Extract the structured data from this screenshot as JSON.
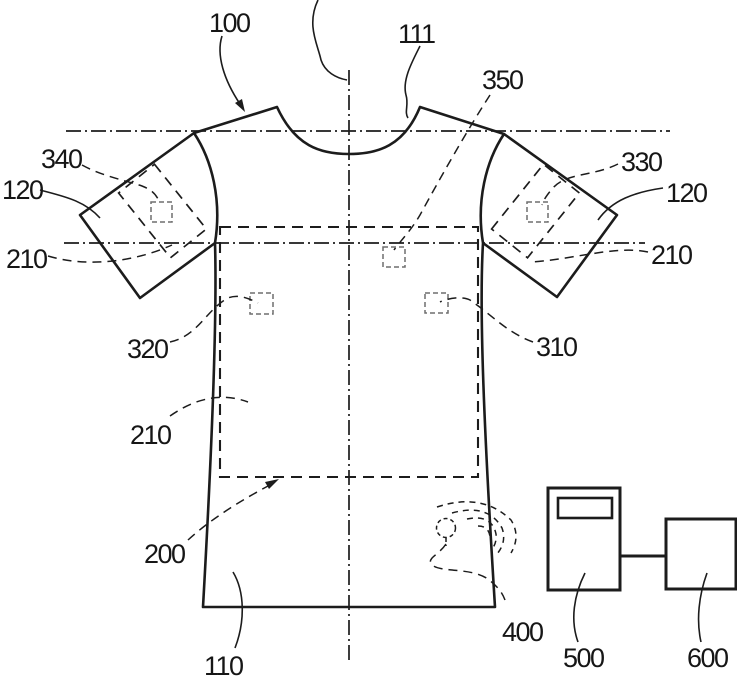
{
  "figure": {
    "colors": {
      "background": "#ffffff",
      "line": "#1c1c1c",
      "sensor_gray": "#6e6e6e"
    },
    "labels": {
      "garment": "100",
      "neckline": "111",
      "chest_sensor": "350",
      "left_sleeve_region": "340",
      "right_sleeve_region": "330",
      "left_sleeve": "120",
      "right_sleeve": "120",
      "axis_left": "210",
      "axis_right": "210",
      "axis_mid": "210",
      "left_torso_sensor": "320",
      "right_torso_sensor": "310",
      "torso_region": "200",
      "hem": "110",
      "transmitter": "400",
      "monitor_device": "500",
      "external_device": "600"
    }
  }
}
